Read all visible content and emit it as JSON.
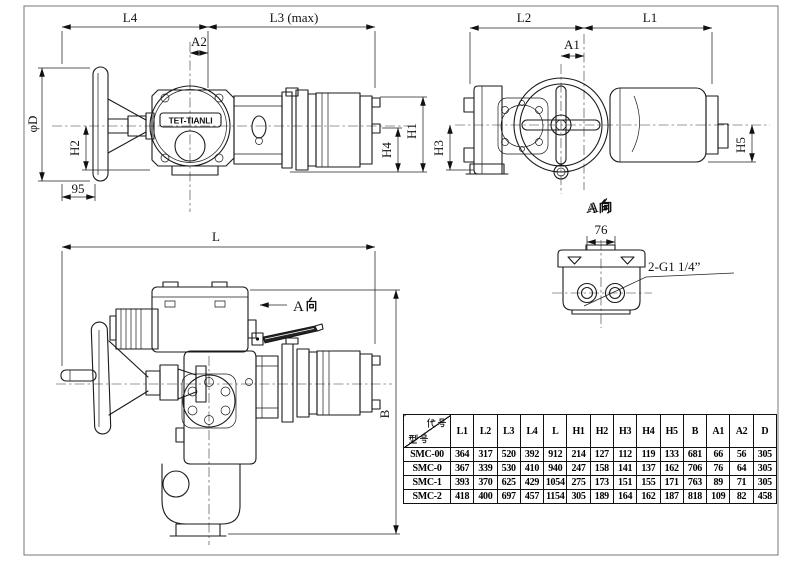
{
  "brand": "TET-TIANLI",
  "labels": {
    "view_a": "A向",
    "view_a_latin": "A"
  },
  "dims": {
    "l4": "L4",
    "l3max": "L3 (max)",
    "a2": "A2",
    "phi_d": "φD",
    "h2": "H2",
    "n95": "95",
    "h4": "H4",
    "h1": "H1",
    "l2": "L2",
    "l1": "L1",
    "a1": "A1",
    "h3": "H3",
    "h5": "H5",
    "l": "L",
    "b": "B",
    "n76": "76",
    "thread": "2-G1 1/4”"
  },
  "table": {
    "corner_top": "代号",
    "corner_bottom": "型号",
    "columns": [
      "L1",
      "L2",
      "L3",
      "L4",
      "L",
      "H1",
      "H2",
      "H3",
      "H4",
      "H5",
      "B",
      "A1",
      "A2",
      "D"
    ],
    "rows": [
      {
        "model": "SMC-00",
        "values": [
          364,
          317,
          520,
          392,
          912,
          214,
          127,
          112,
          119,
          133,
          681,
          66,
          56,
          305
        ]
      },
      {
        "model": "SMC-0",
        "values": [
          367,
          339,
          530,
          410,
          940,
          247,
          158,
          141,
          137,
          162,
          706,
          76,
          64,
          305
        ]
      },
      {
        "model": "SMC-1",
        "values": [
          393,
          370,
          625,
          429,
          1054,
          275,
          173,
          151,
          155,
          171,
          763,
          89,
          71,
          305
        ]
      },
      {
        "model": "SMC-2",
        "values": [
          418,
          400,
          697,
          457,
          1154,
          305,
          189,
          164,
          162,
          187,
          818,
          109,
          82,
          458
        ]
      }
    ]
  }
}
